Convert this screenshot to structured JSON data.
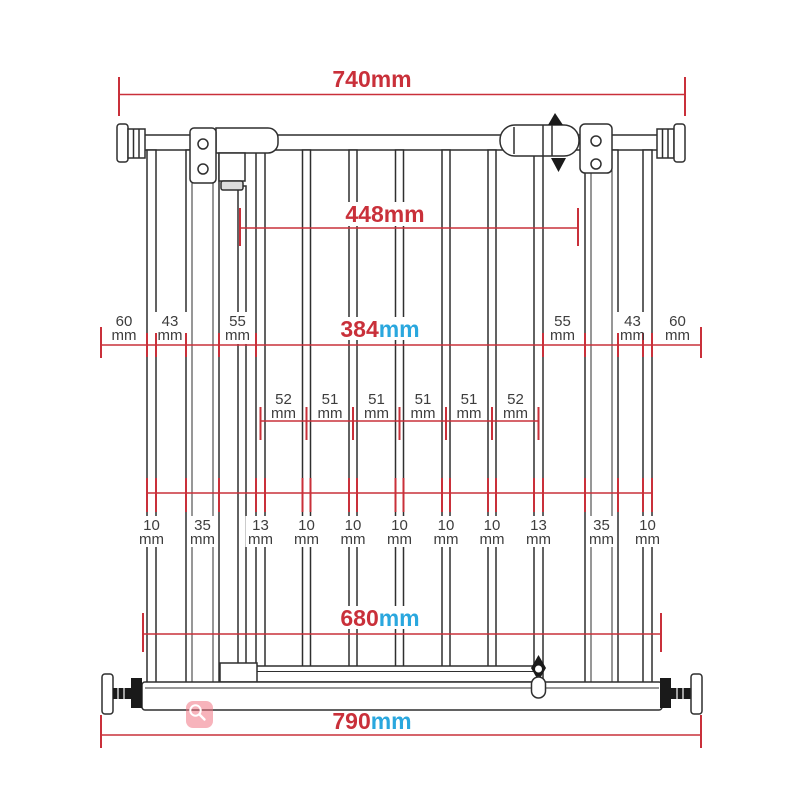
{
  "diagram": {
    "subject": "Pressure-fit safety gate dimension drawing",
    "units": {
      "mm": "mm"
    },
    "colors": {
      "dimension_red": "#c9303a",
      "unit_blue": "#2aa7de",
      "detail_gray": "#3d3d3d",
      "line_art": "#2f2f2f",
      "watermark_pink": "#f07584"
    },
    "dimensions": {
      "overall_top": "740",
      "inner_top": "448",
      "mid_center": "384",
      "mid_left": [
        "60",
        "43",
        "55"
      ],
      "mid_right": [
        "55",
        "43",
        "60"
      ],
      "bar_gaps": [
        "52",
        "51",
        "51",
        "51",
        "51",
        "52"
      ],
      "bar_widths": [
        "10",
        "35",
        "13",
        "10",
        "10",
        "10",
        "10",
        "10",
        "13",
        "35",
        "10"
      ],
      "inner_bottom": "680",
      "overall_bottom": "790"
    },
    "watermark": {
      "icon": "magnifier"
    }
  }
}
